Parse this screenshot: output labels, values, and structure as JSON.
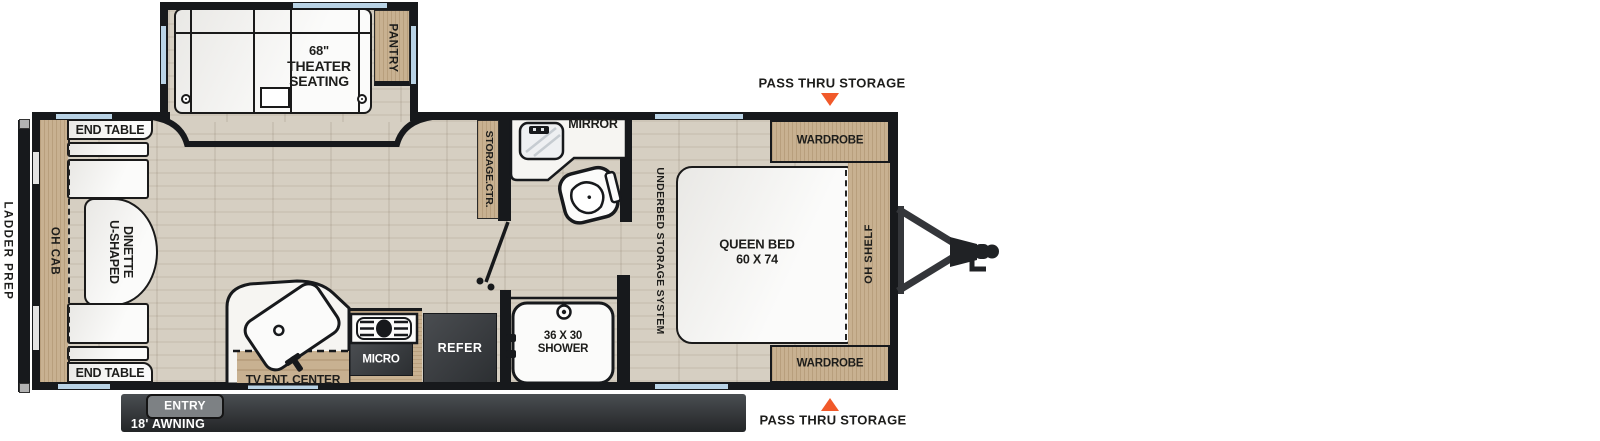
{
  "diagram": {
    "type": "rv-travel-trailer-floorplan",
    "canvas": {
      "width": 1600,
      "height": 441
    }
  },
  "labels": {
    "ladder_prep": "LADDER PREP",
    "oh_cab": "OH CAB",
    "end_table_top": "END TABLE",
    "end_table_bottom": "END TABLE",
    "dinette_line1": "U-SHAPED",
    "dinette_line2": "DINETTE",
    "theater_line1": "68\"",
    "theater_line2": "THEATER",
    "theater_line3": "SEATING",
    "pantry": "PANTRY",
    "storage_ctr": "STORAGE.CTR.",
    "mirror": "MIRROR",
    "underbed": "UNDERBED STORAGE SYSTEM",
    "queen_line1": "QUEEN BED",
    "queen_line2": "60 X 74",
    "oh_shelf": "OH SHELF",
    "wardrobe_top": "WARDROBE",
    "wardrobe_bottom": "WARDROBE",
    "pass_thru_top": "PASS THRU STORAGE",
    "pass_thru_bottom": "PASS THRU STORAGE",
    "micro": "MICRO",
    "refer": "REFER",
    "shower_line1": "36 X 30",
    "shower_line2": "SHOWER",
    "tv_ent_center": "TV ENT. CENTER",
    "entry": "ENTRY",
    "awning": "18' AWNING"
  },
  "colors": {
    "wall": "#17191c",
    "floor": "#d6cfc2",
    "wood": "#c8b191",
    "window": "#b9d3e6",
    "appliance": "#3b3e41",
    "awning_bar": "#2e3134",
    "entry_tab": "#7d8184",
    "arrow": "#f1592a",
    "fixture": "#f5f4f1",
    "text": "#1d1d1b"
  }
}
